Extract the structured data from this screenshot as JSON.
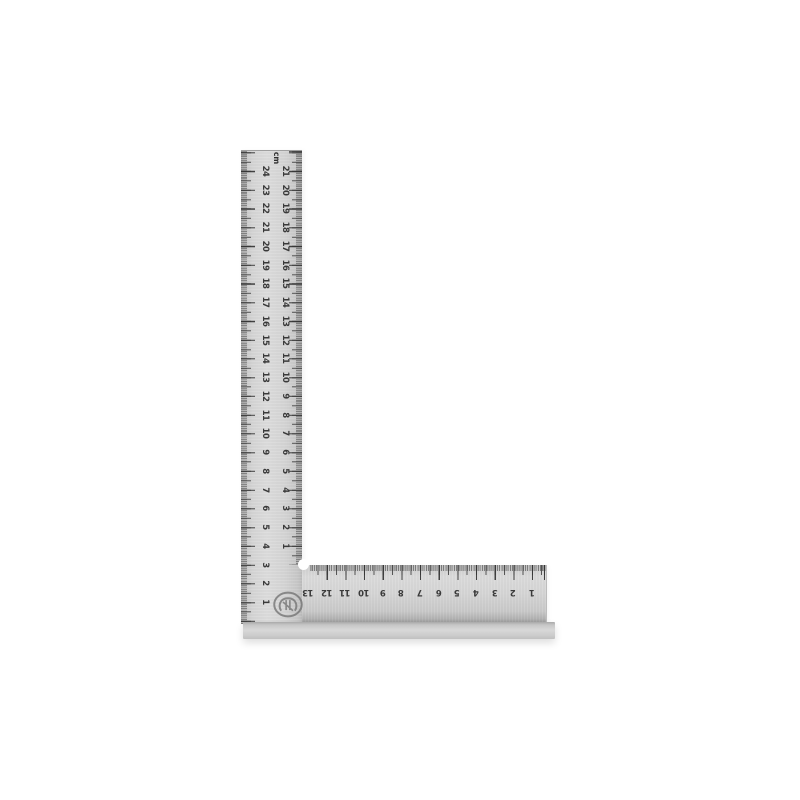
{
  "scene": {
    "background_color": "#ffffff",
    "product_name": "steel try square (L-shaped ruler)"
  },
  "square": {
    "unit_label": "cm",
    "vertical_blade": {
      "outer_scale_numbers": [
        24,
        23,
        22,
        21,
        20,
        19,
        18,
        17,
        16,
        15,
        14,
        13,
        12,
        11,
        10,
        9,
        8,
        7,
        6,
        5,
        4,
        3,
        2,
        1
      ],
      "inner_scale_numbers": [
        21,
        20,
        19,
        18,
        17,
        16,
        15,
        14,
        13,
        12,
        11,
        10,
        9,
        8,
        7,
        6,
        5,
        4,
        3,
        2,
        1
      ]
    },
    "horizontal_blade": {
      "scale_numbers": [
        13,
        12,
        11,
        10,
        9,
        8,
        7,
        6,
        5,
        4,
        3,
        2,
        1
      ]
    },
    "colors": {
      "blade": "#d6d6d6",
      "blade_edge": "#9f9f9f",
      "tick": "#4b4b4b",
      "number": "#3a3a3a",
      "base": "#c7c7c7",
      "background": "#ffffff"
    }
  }
}
